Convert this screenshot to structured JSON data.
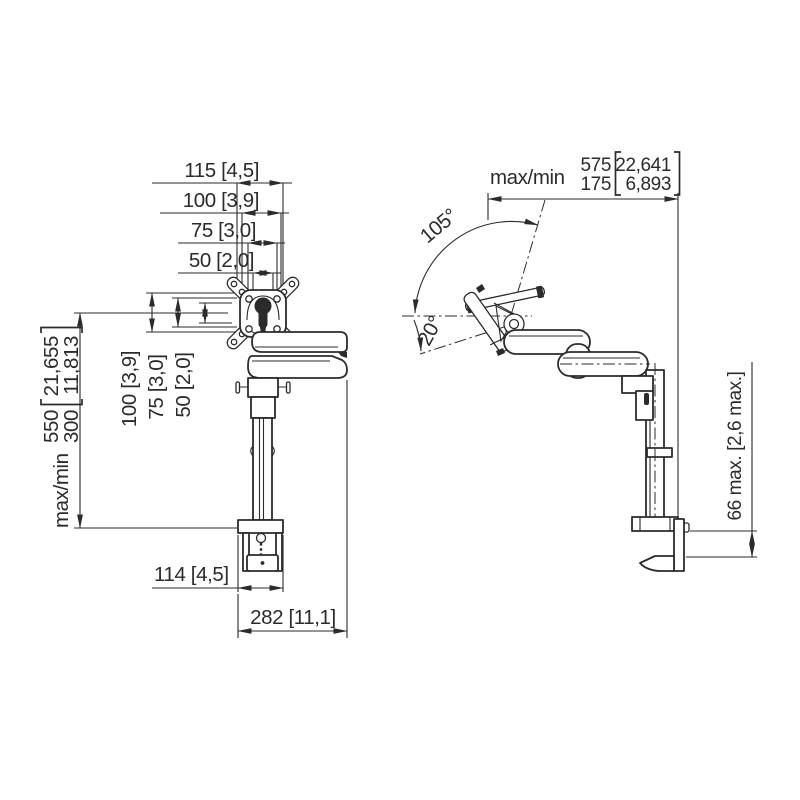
{
  "page": {
    "background": "#ffffff",
    "line_color": "#2b2b2b"
  },
  "front_view": {
    "vesa_width_dims": [
      "115 [4,5]",
      "100 [3,9]",
      "75 [3,0]",
      "50 [2,0]"
    ],
    "vesa_height_dims": [
      "100 [3,9]",
      "75 [3,0]",
      "50 [2,0]"
    ],
    "height_range": {
      "label": "max/min",
      "max_mm": "550",
      "min_mm": "300",
      "max_in": "21,655",
      "min_in": "11,813"
    },
    "clamp_width_dim": "114 [4,5]",
    "overall_width_dim": "282 [11,1]"
  },
  "side_view": {
    "depth_range": {
      "label": "max/min",
      "max_mm": "575",
      "min_mm": "175",
      "max_in": "22,641",
      "min_in": "6,893"
    },
    "tilt_up_angle": "105°",
    "tilt_down_angle": "20°",
    "desk_clamp_range_dim": "66 max. [2,6 max.]"
  }
}
